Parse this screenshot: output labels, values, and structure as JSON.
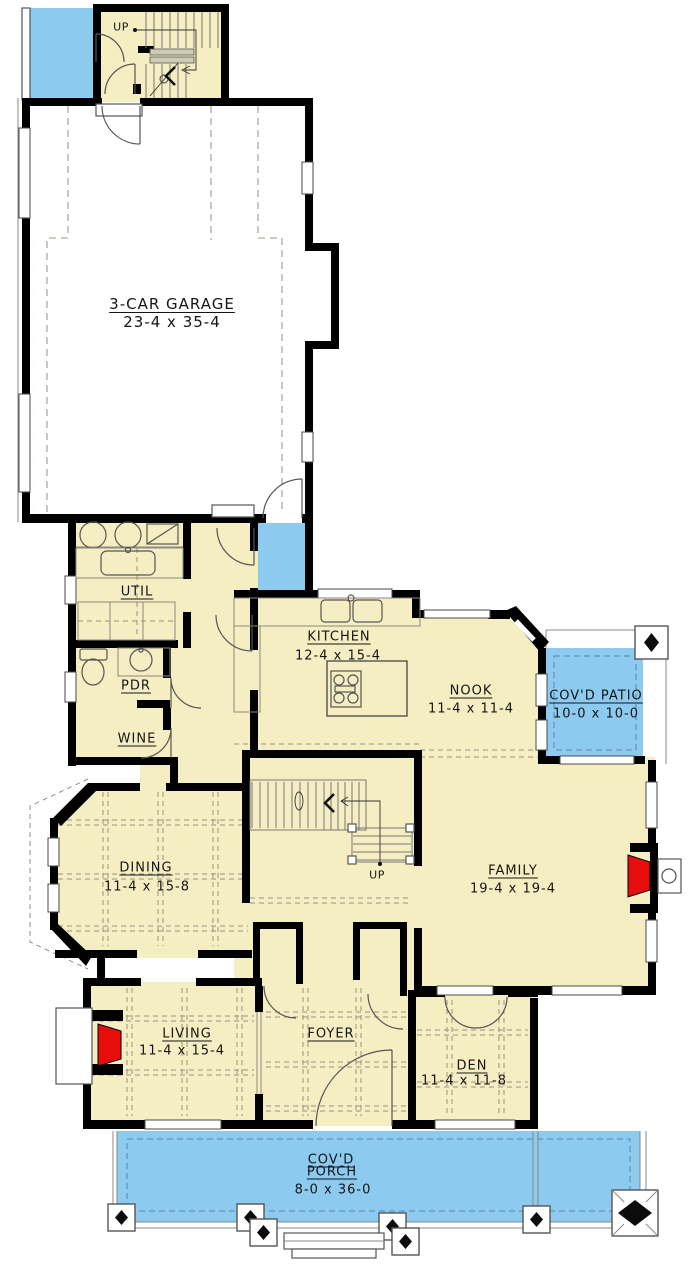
{
  "colors": {
    "floor": "#F5EEC2",
    "outdoor": "#8CCAEF",
    "wall": "#000000",
    "fireplace": "#E80D0D"
  },
  "rooms": {
    "garage": {
      "name": "3-CAR GARAGE",
      "dims": "23-4 x 35-4"
    },
    "util": {
      "name": "UTIL"
    },
    "pdr": {
      "name": "PDR"
    },
    "wine": {
      "name": "WINE"
    },
    "kitchen": {
      "name": "KITCHEN",
      "dims": "12-4 x 15-4"
    },
    "nook": {
      "name": "NOOK",
      "dims": "11-4 x 11-4"
    },
    "patio": {
      "name": "COV'D PATIO",
      "dims": "10-0 x 10-0"
    },
    "dining": {
      "name": "DINING",
      "dims": "11-4 x 15-8"
    },
    "family": {
      "name": "FAMILY",
      "dims": "19-4 x 19-4"
    },
    "living": {
      "name": "LIVING",
      "dims": "11-4 x 15-4"
    },
    "foyer": {
      "name": "FOYER"
    },
    "den": {
      "name": "DEN",
      "dims": "11-4 x 11-8"
    },
    "porch": {
      "name_line1": "COV'D",
      "name_line2": "PORCH",
      "dims": "8-0 x 36-0"
    }
  },
  "stairs": {
    "upper_label": "UP",
    "main_label": "UP"
  }
}
